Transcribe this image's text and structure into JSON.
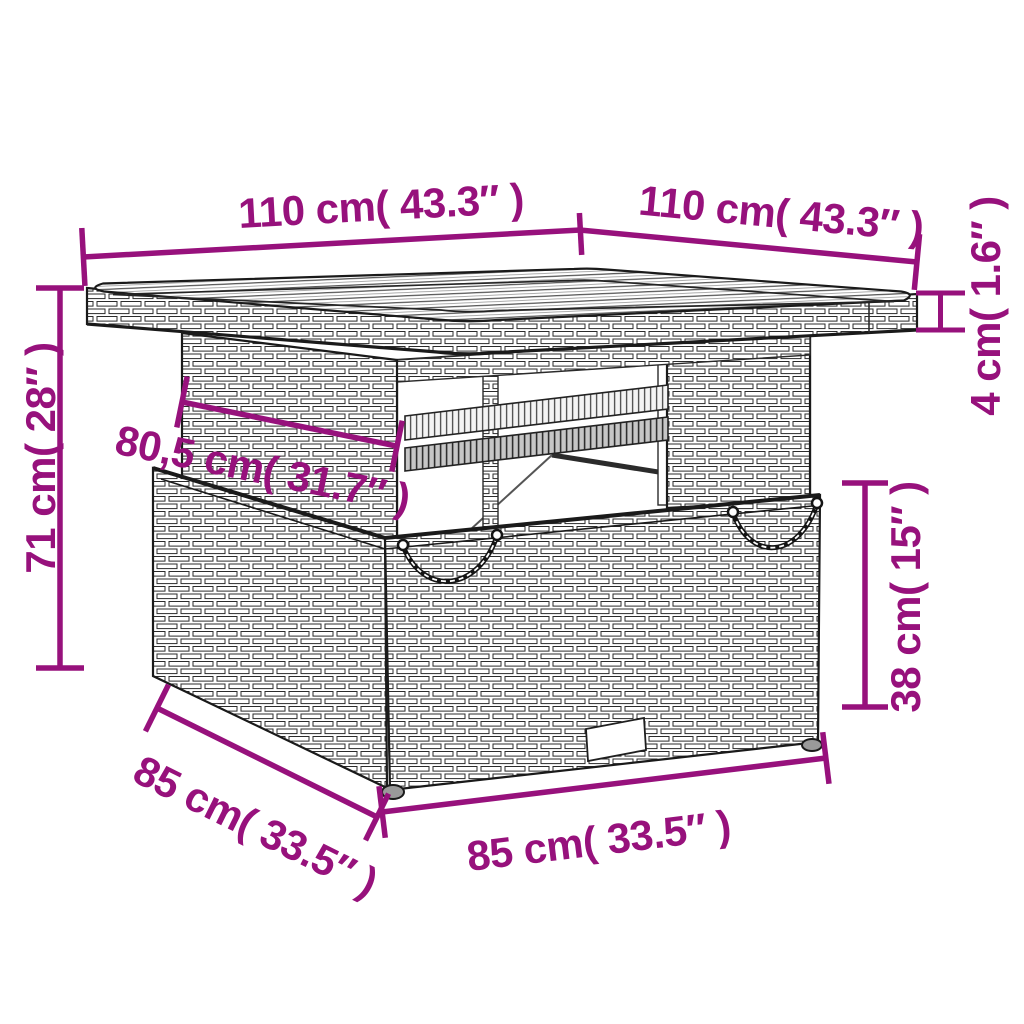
{
  "diagram": {
    "title": "Poly rattan garden table — dimension drawing",
    "background_color": "#ffffff",
    "accent_color": "#97117C",
    "line_color": "#1a1a1a",
    "dimensions": [
      {
        "id": "tabletop-depth-left",
        "label": "110 cm( 43.3″ )"
      },
      {
        "id": "tabletop-width-right",
        "label": "110 cm( 43.3″ )"
      },
      {
        "id": "tabletop-thickness",
        "label": "4 cm( 1.6″ )"
      },
      {
        "id": "total-height",
        "label": "71 cm( 28″ )"
      },
      {
        "id": "pedestal-width",
        "label": "80,5 cm( 31.7″ )"
      },
      {
        "id": "base-height",
        "label": "38 cm( 15″ )"
      },
      {
        "id": "base-depth",
        "label": "85 cm( 33.5″ )"
      },
      {
        "id": "base-width",
        "label": "85 cm( 33.5″ )"
      }
    ]
  }
}
